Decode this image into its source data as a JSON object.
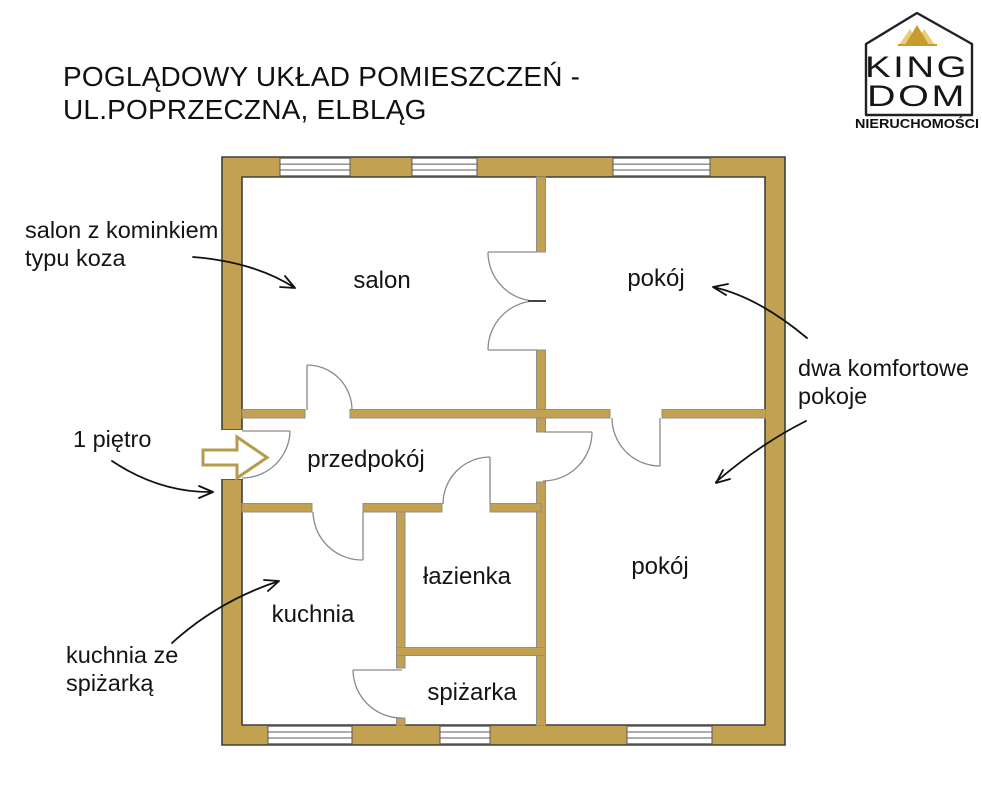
{
  "title": {
    "line1": "POGLĄDOWY UKŁAD POMIESZCZEŃ -",
    "line2": "UL.POPRZECZNA, ELBLĄG"
  },
  "logo": {
    "word_top": "KING",
    "word_bottom": "DOM",
    "subtitle": "NIERUCHOMOŚCI"
  },
  "rooms": {
    "salon": "salon",
    "pokoj_top": "pokój",
    "przedpokoj": "przedpokój",
    "lazienka": "łazienka",
    "pokoj_bottom": "pokój",
    "kuchnia": "kuchnia",
    "spizarka": "spiżarka"
  },
  "annotations": {
    "salon_note_line1": "salon z kominkiem",
    "salon_note_line2": "typu koza",
    "floor_note": "1 piętro",
    "rooms_note_line1": "dwa komfortowe",
    "rooms_note_line2": "pokoje",
    "kitchen_note_line1": "kuchnia ze",
    "kitchen_note_line2": "spiżarką"
  },
  "colors": {
    "wall": "#C2A251",
    "wall_outline": "#3F3F3F",
    "inner_line": "#8F8F8F",
    "door_line": "#8A8A8A",
    "text": "#141414",
    "arrow_gold": "#B49C4C",
    "crown_dark": "#C89B2F",
    "crown_light": "#E9CD78",
    "logo_outline": "#222222"
  }
}
